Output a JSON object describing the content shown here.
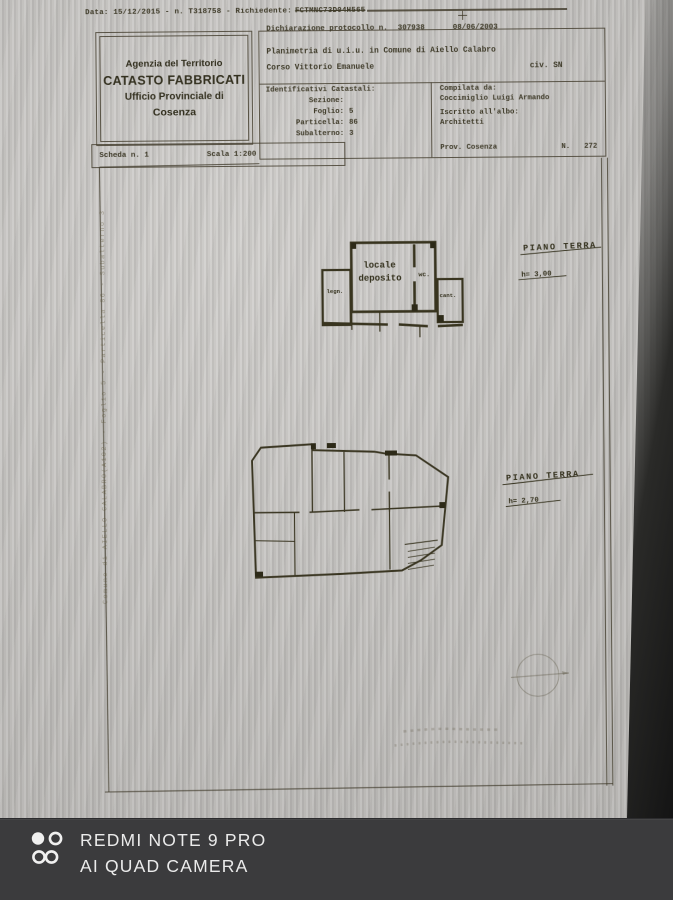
{
  "colors": {
    "ink": "#3e3a28",
    "paper": "#c7c5c2",
    "camera_bar": "#3b3b3d",
    "bezel": "#1e1e1e",
    "watermark_text": "#ebebeb"
  },
  "camera_watermark": {
    "line1": "REDMI NOTE 9 PRO",
    "line2": "AI QUAD CAMERA"
  },
  "doc": {
    "top_line": {
      "prefix": "Data: 15/12/2015 - n. T318758 - Richiedente:",
      "code": "FCTMNC73D04H565"
    },
    "office_box": {
      "line1": "Agenzia del Territorio",
      "line2": "CATASTO FABBRICATI",
      "line3": "Ufficio Provinciale di",
      "line4": "Cosenza"
    },
    "protocol": {
      "label": "Dichiarazione protocollo n.",
      "number": "307938",
      "date": "08/06/2003"
    },
    "subject": {
      "planimetria": "Planimetria di u.i.u. in Comune di Aiello Calabro",
      "address": "Corso Vittorio Emanuele",
      "civic": "civ. SN"
    },
    "ids": {
      "title": "Identificativi Catastali:",
      "rows": [
        {
          "label": "Sezione:",
          "value": ""
        },
        {
          "label": "Foglio:",
          "value": "5"
        },
        {
          "label": "Particella:",
          "value": "86"
        },
        {
          "label": "Subalterno:",
          "value": "3"
        }
      ]
    },
    "compiler": {
      "label": "Compilata da:",
      "name": "Coccimiglio Luigi Armando",
      "register_label": "Iscritto all'albo:",
      "register": "Architetti",
      "province": "Prov. Cosenza",
      "number_label": "N.",
      "number": "272"
    },
    "sheet_row": {
      "scheda": "Scheda n. 1",
      "scala": "Scala 1:200"
    },
    "plan_top": {
      "title": "PIANO TERRA",
      "height": "h= 3,00",
      "room_main_line1": "locale",
      "room_main_line2": "deposito",
      "room_wc": "wc.",
      "room_left": "legn.",
      "room_right": "cant."
    },
    "plan_bottom": {
      "title": "PIANO TERRA",
      "height": "h= 2,70"
    },
    "side_watermark": "Comune di AIELLO CALABRO(A102) - Foglio 5 - Particella 86 - Subalterno 3"
  }
}
